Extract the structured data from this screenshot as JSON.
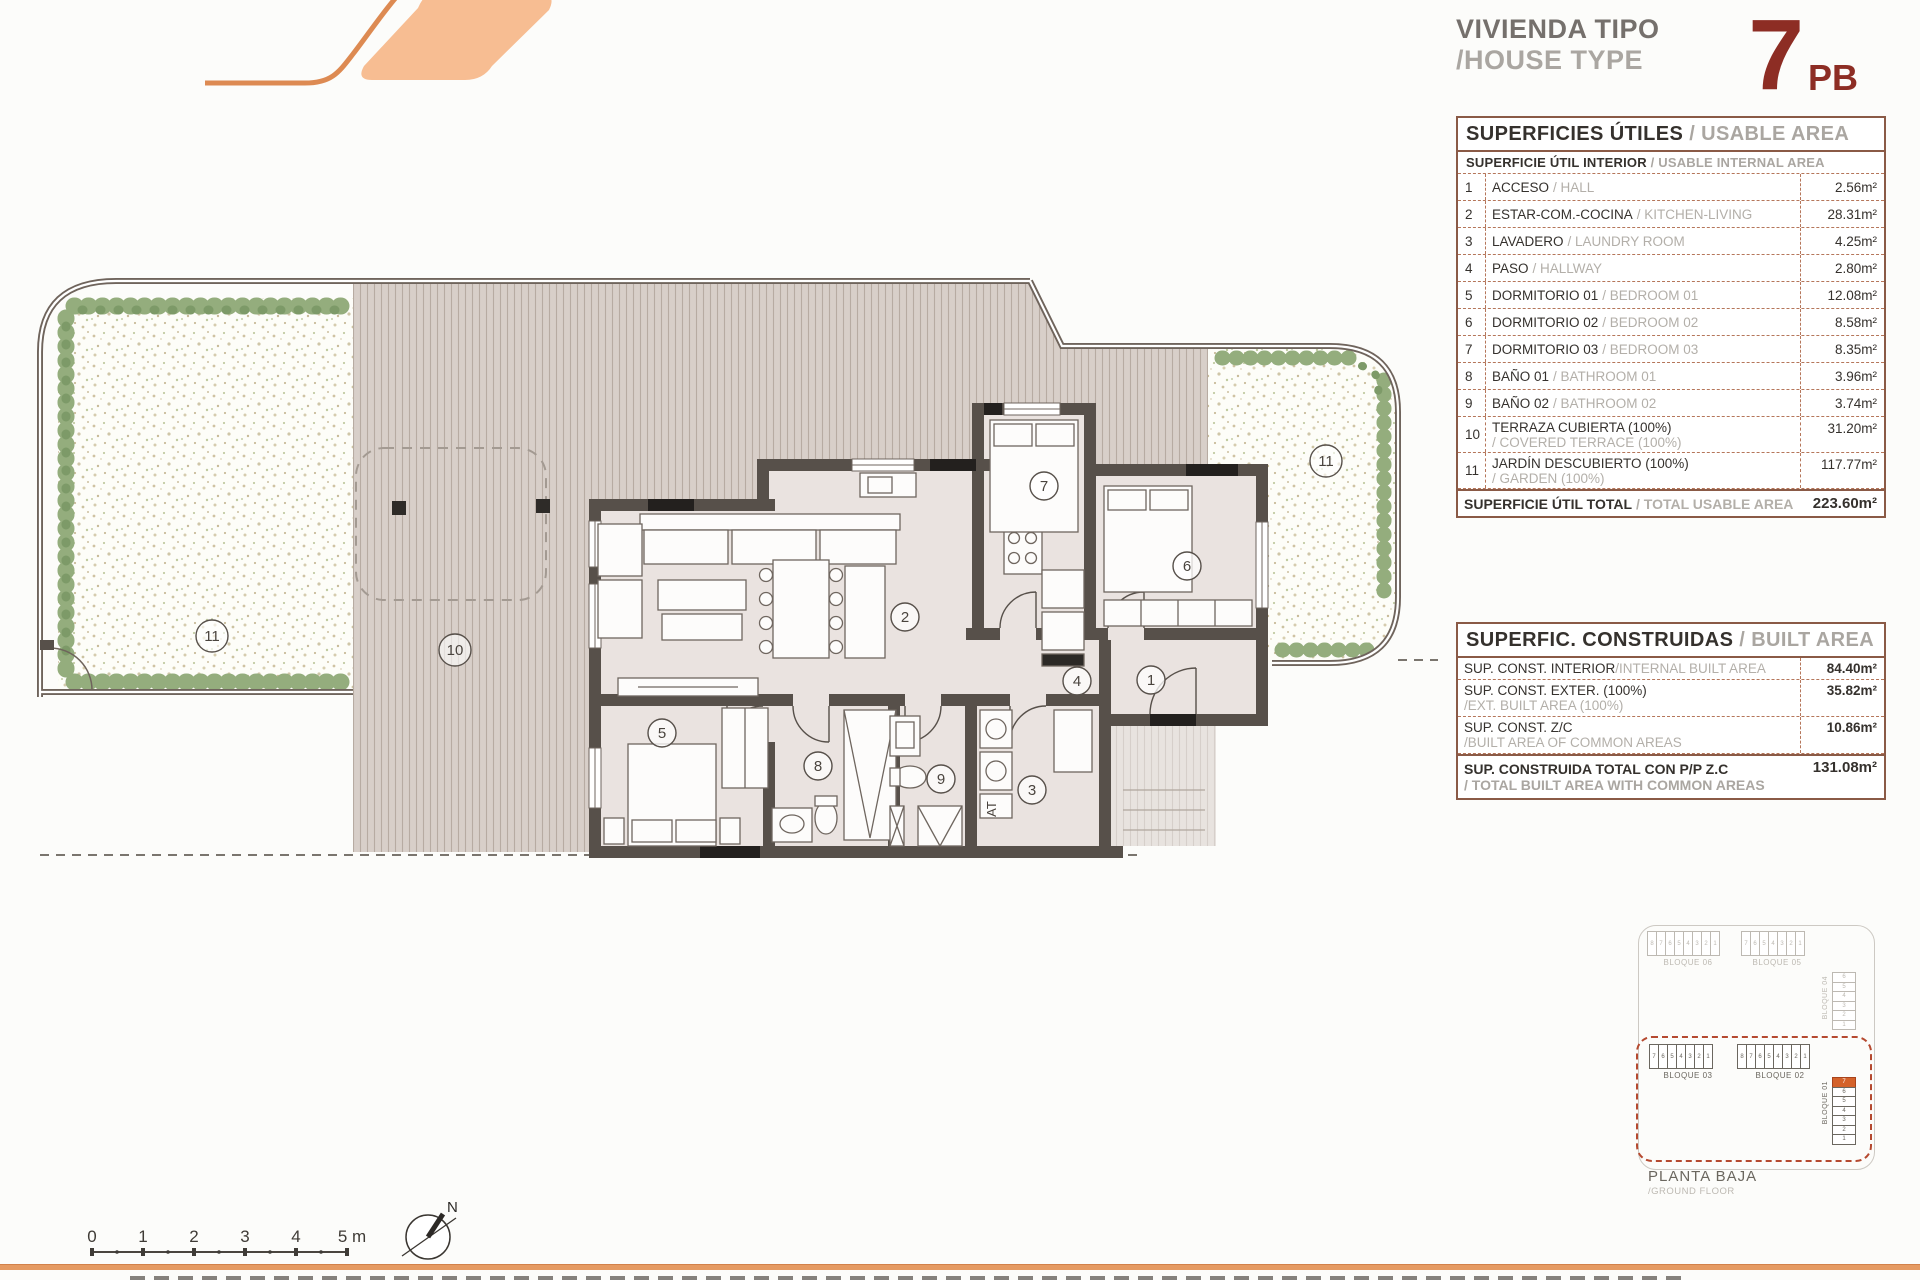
{
  "header": {
    "title_line1": "VIVIENDA TIPO",
    "title_line2": "/HOUSE TYPE",
    "type_number": "7",
    "type_suffix": "PB"
  },
  "usable_table": {
    "title_es": "SUPERFICIES ÚTILES",
    "title_en": "/ USABLE AREA",
    "subtitle_es": "SUPERFICIE ÚTIL INTERIOR",
    "subtitle_en": "/ USABLE INTERNAL AREA",
    "rows": [
      {
        "num": "1",
        "es": "ACCESO",
        "en": "/ HALL",
        "area": "2.56m²"
      },
      {
        "num": "2",
        "es": "ESTAR-COM.-COCINA",
        "en": "/ KITCHEN-LIVING",
        "area": "28.31m²"
      },
      {
        "num": "3",
        "es": "LAVADERO",
        "en": "/ LAUNDRY ROOM",
        "area": "4.25m²"
      },
      {
        "num": "4",
        "es": "PASO",
        "en": "/ HALLWAY",
        "area": "2.80m²"
      },
      {
        "num": "5",
        "es": "DORMITORIO 01",
        "en": "/ BEDROOM 01",
        "area": "12.08m²"
      },
      {
        "num": "6",
        "es": "DORMITORIO 02",
        "en": "/ BEDROOM 02",
        "area": "8.58m²"
      },
      {
        "num": "7",
        "es": "DORMITORIO 03",
        "en": "/ BEDROOM 03",
        "area": "8.35m²"
      },
      {
        "num": "8",
        "es": "BAÑO 01",
        "en": "/ BATHROOM 01",
        "area": "3.96m²"
      },
      {
        "num": "9",
        "es": "BAÑO 02",
        "en": "/ BATHROOM 02",
        "area": "3.74m²"
      },
      {
        "num": "10",
        "es": "TERRAZA CUBIERTA (100%)",
        "en": "/ COVERED TERRACE (100%)",
        "area": "31.20m²"
      },
      {
        "num": "11",
        "es": "JARDÍN DESCUBIERTO (100%)",
        "en": "/ GARDEN (100%)",
        "area": "117.77m²"
      }
    ],
    "total_es": "SUPERFICIE ÚTIL TOTAL",
    "total_en": "/ TOTAL USABLE AREA",
    "total_area": "223.60m²"
  },
  "built_table": {
    "title_es": "SUPERFIC. CONSTRUIDAS",
    "title_en": "/ BUILT AREA",
    "rows": [
      {
        "es": "SUP. CONST. INTERIOR",
        "en": "/INTERNAL BUILT AREA",
        "area": "84.40m²"
      },
      {
        "es": "SUP. CONST. EXTER. (100%)",
        "en": "/EXT. BUILT AREA (100%)",
        "area": "35.82m²"
      },
      {
        "es": "SUP. CONST. Z/C",
        "en": "/BUILT AREA OF COMMON AREAS",
        "area": "10.86m²"
      }
    ],
    "total_es": "SUP. CONSTRUIDA TOTAL CON P/P Z.C",
    "total_en": "/ TOTAL BUILT AREA WITH COMMON AREAS",
    "total_area": "131.08m²"
  },
  "plan": {
    "labels": {
      "acceso": "1",
      "estar": "2",
      "lavadero": "3",
      "paso": "4",
      "dorm1": "5",
      "dorm2": "6",
      "dorm3": "7",
      "bano1": "8",
      "bano2": "9",
      "terraza": "10",
      "jardin_left": "11",
      "jardin_right": "11",
      "laundry_tag": "AT"
    },
    "colors": {
      "wall": "#57504a",
      "deck": "#d8cfc9",
      "accent_orange": "#e59a62",
      "brand_red": "#8d2d24",
      "hedge_green": "#94ad7d"
    }
  },
  "keyplan": {
    "bloque06": {
      "label": "BLOQUE 06",
      "units": [
        "8",
        "7",
        "6",
        "5",
        "4",
        "3",
        "2",
        "1"
      ]
    },
    "bloque05": {
      "label": "BLOQUE 05",
      "units": [
        "7",
        "6",
        "5",
        "4",
        "3",
        "2",
        "1"
      ]
    },
    "bloque04": {
      "label": "BLOQUE 04",
      "units": [
        "6",
        "5",
        "4",
        "3",
        "2",
        "1"
      ]
    },
    "bloque03": {
      "label": "BLOQUE 03",
      "units": [
        "7",
        "6",
        "5",
        "4",
        "3",
        "2",
        "1"
      ]
    },
    "bloque02": {
      "label": "BLOQUE 02",
      "units": [
        "8",
        "7",
        "6",
        "5",
        "4",
        "3",
        "2",
        "1"
      ]
    },
    "bloque01": {
      "label": "BLOQUE 01",
      "units": [
        "7",
        "6",
        "5",
        "4",
        "3",
        "2",
        "1"
      ],
      "highlight_index": "0"
    },
    "caption_line1": "PLANTA BAJA",
    "caption_line2": "/GROUND FLOOR"
  },
  "scalebar": {
    "labels": [
      "0",
      "1",
      "2",
      "3",
      "4"
    ],
    "end_label": "5 m"
  },
  "north_label": "N"
}
